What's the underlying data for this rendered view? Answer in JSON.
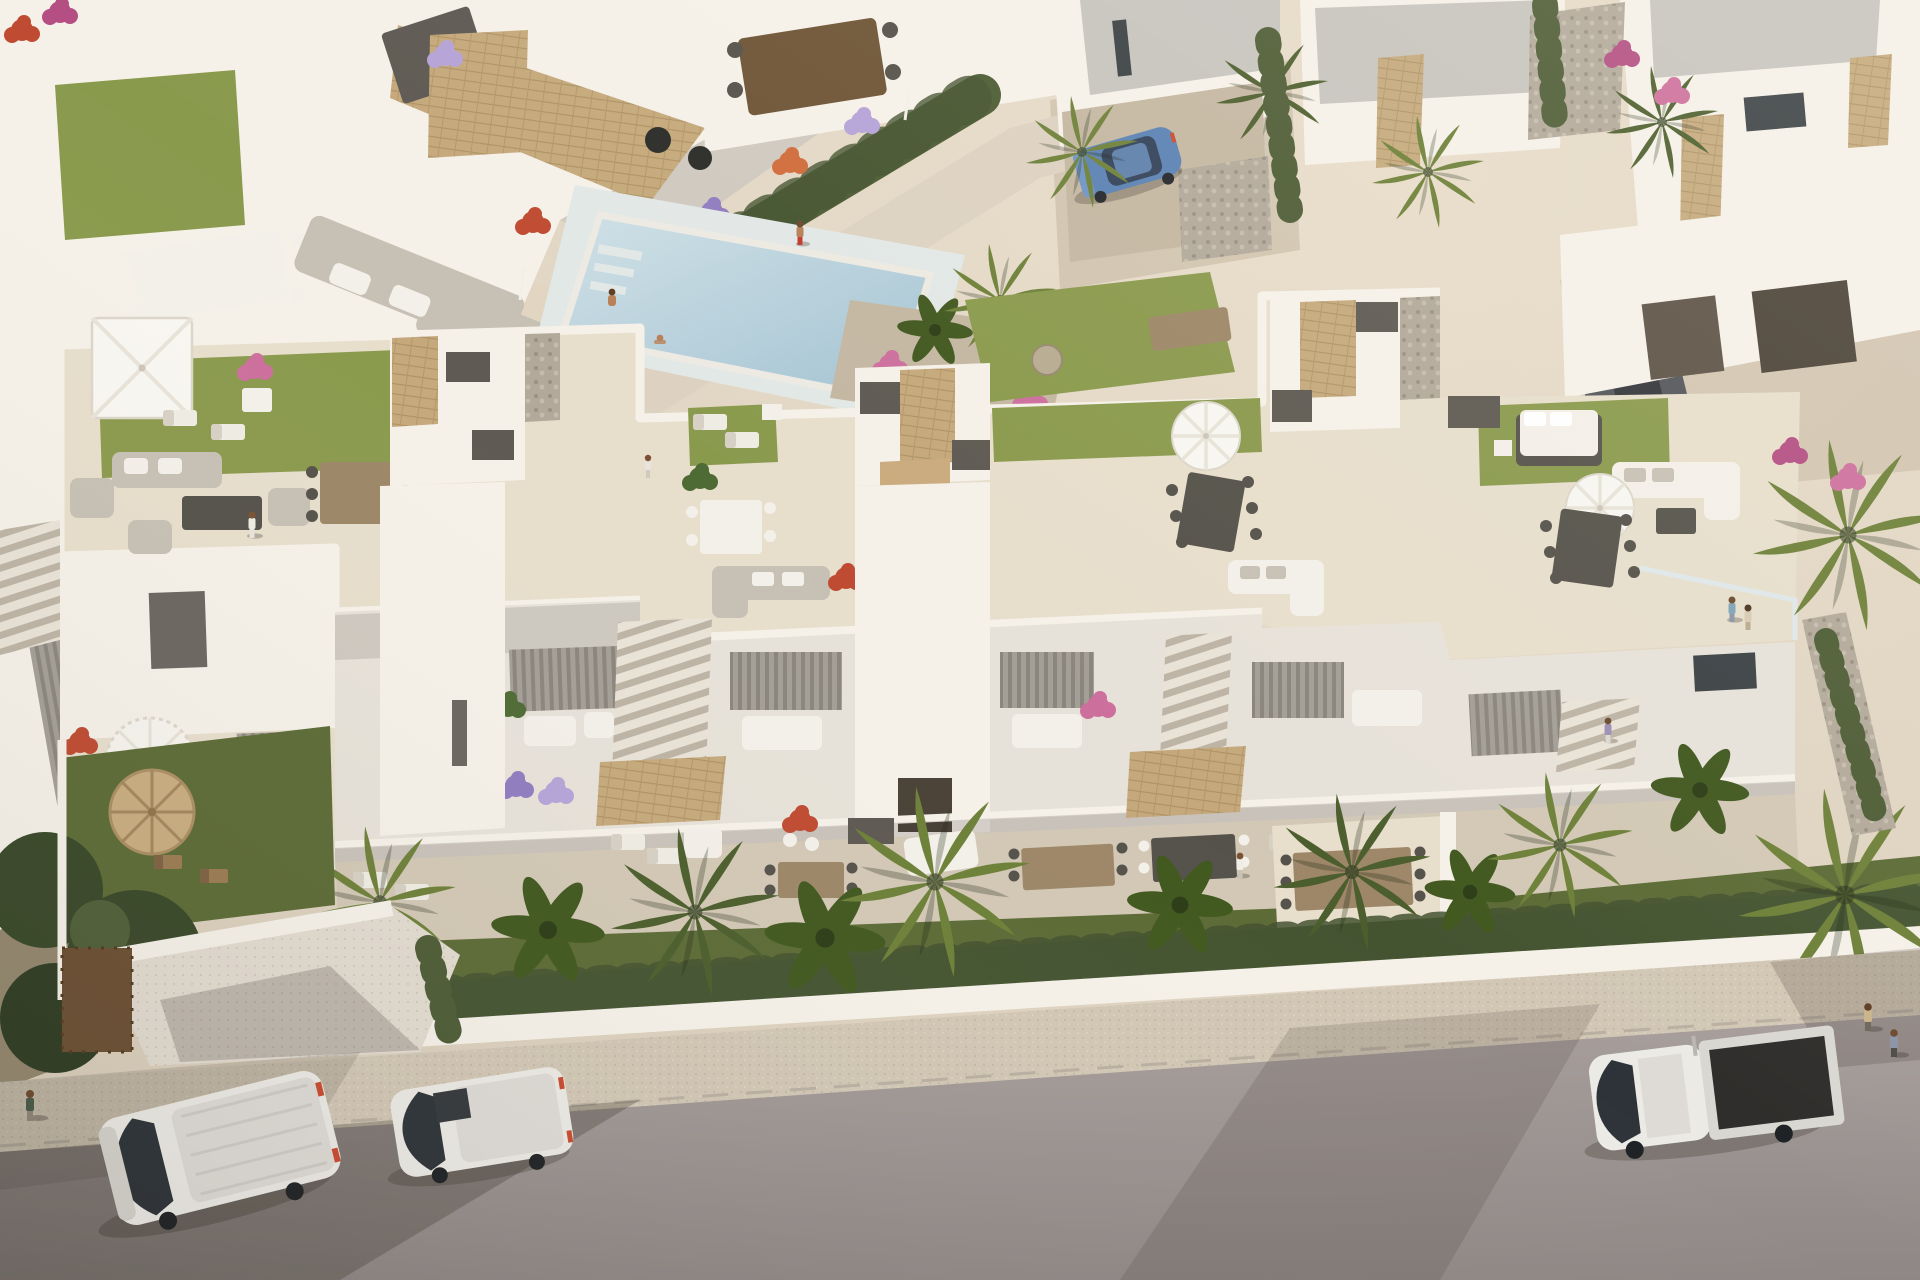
{
  "meta": {
    "type": "3d-architectural-aerial-render",
    "description": "Golden-hour aerial 3D rendering of a modern white Mediterranean residential development: a four-unit terraced apartment block with furnished rooftop terraces (artificial lawns, parasols, lounge and dining sets), recessed balconies and private front gardens behind a hedge-topped white wall; a communal pool with a planted promenade behind the block; surrounding white villas with stone-clad accents; an asphalt street in front with parked white vans and a flatbed pickup.",
    "time_of_day": "late afternoon, warm sunlight from upper right, long soft shadows toward lower left"
  },
  "palette": {
    "sand": "#d7cbb8",
    "sandLit": "#e8ddca",
    "gravel": "#c4b7a2",
    "dirt": "#93876e",
    "path": "#ddd2c2",
    "deck": "#e4dbc9",
    "travertine": "#e7decc",
    "travShade": "#d2c8b5",
    "wallLit": "#f5f1e9",
    "wallMid": "#e7e2d9",
    "wallShade": "#cfc9c0",
    "wallDim": "#b7b1a9",
    "roofGray": "#c7c4bf",
    "boxDark": "#5e5a53",
    "glass": "#3a4044",
    "curtain": "#908b84",
    "lawn": "#77873f",
    "lawnBright": "#8a9a4d",
    "lawnDark": "#5c6b36",
    "hedge": "#4d5c35",
    "cypress": "#435230",
    "treeDark": "#394829",
    "palmLight": "#6d8038",
    "palmDark": "#4c5e2d",
    "banana": "#41581f",
    "stoneTan": "#c3a87c",
    "pebble": "#b2a99a",
    "woodLight": "#c9ab7e",
    "woodMid": "#9d8768",
    "woodDark": "#6e5436",
    "furnWhite": "#f3f0e9",
    "furnGray": "#c7c0b4",
    "furnDark": "#55524b",
    "umbWhite": "#f8f6f1",
    "straw": "#c8ad7f",
    "poolLight": "#cfe0e6",
    "poolDeep": "#a2c2d2",
    "poolStep": "#e2e8e6",
    "road": "#a89f9d",
    "roadDark": "#8e8785",
    "sidewalk": "#d2c7b5",
    "curb": "#b9b0a2",
    "vehWhite": "#eceae5",
    "vehShade": "#cbc8c3",
    "vehGlass": "#2d3338",
    "carBlue": "#5b82b4",
    "carDark": "#53555a",
    "skin": "#b97f57",
    "shadow": "#3c342c",
    "flowerPurple": "#8f7cc0",
    "flowerLav": "#b5a3d8",
    "flowerPink": "#cd6f9d",
    "flowerMagenta": "#b44e83",
    "flowerRed": "#bf4b32",
    "flowerOrange": "#d06c3c",
    "flowerWhite": "#eef0f1"
  },
  "scene": {
    "main_building": {
      "label": "white terraced apartment block with staggered roofline",
      "units": 4,
      "rooftop_features": [
        "artificial lawn patches",
        "white square parasol",
        "two round white parasols",
        "gray lounge set with barbecue console",
        "wood dining set with six chairs",
        "white dining set",
        "gray corner sofa",
        "white corner sofas",
        "sun loungers",
        "double daybed on lawn",
        "stone-clad stair bulkheads with dark planter boxes",
        "pebble strips",
        "glass balustrade with standing couple"
      ],
      "facade_features": [
        "recessed balconies with gray curtain glazing",
        "white parapets",
        "purple petunia flower boxes",
        "cantilevered sandstone canopies",
        "external white staircases",
        "dark timber entrance doors"
      ]
    },
    "amenities": {
      "pool": {
        "label": "communal swimming pool",
        "water": "pale blue",
        "details": [
          "white coping",
          "corner entry steps",
          "pale sun deck"
        ]
      },
      "promenade": {
        "label": "paved promenade",
        "planting": "clipped cypress hedge bordered by purple, white and orange flower beds"
      },
      "landscape_objects": [
        "palm island with pink, red and white flowers",
        "lawn with round stone sphere sculpture",
        "timber slat bench",
        "tall fan palms",
        "banana plants"
      ]
    },
    "neighborhood": {
      "top_left": "rear roof terraces of an identical townhouse row: lawn patch, white dining set, gray corner sofa, red planter, stone-clad stair wall, striped curtain glazing, purple balcony flowers",
      "top_center": "patio with pergola dining set, black planter pots, sandstone feature walls",
      "top_right": "detached white villas with flat gray roofs, sandstone-clad pillars, gravel drives, rock beds, pink bougainvillea and palms",
      "right": "neighbor villa garage court with dark parked car"
    },
    "gardens": {
      "front": [
        "ground-floor terraces with loungers, day beds and long timber dining tables",
        "dark green lawns",
        "row of fan palms and banana plants",
        "clipped hedge on white boundary wall",
        "straw parasol with two wooden deck chairs in left garden",
        "dark garden trees at lower left",
        "right garden patio with eight-seat timber table"
      ],
      "left": "walled drive-in court with white parapet walls and dark timber garage gate"
    },
    "street": {
      "surface": "asphalt road, concrete sidewalk with expansion joints",
      "vehicles": [
        {
          "type": "panel van",
          "color": "white",
          "position": "parked at left, angled toward curb"
        },
        {
          "type": "compact van",
          "color": "white",
          "position": "parked left of center"
        },
        {
          "type": "flatbed pickup truck",
          "color": "white with dark bed",
          "position": "parked at right"
        },
        {
          "type": "hatchback",
          "color": "steel blue",
          "position": "villa driveway, upper right"
        },
        {
          "type": "car",
          "color": "dark gray",
          "position": "garage court behind right end of block"
        }
      ]
    },
    "people": [
      {
        "activity": "walking",
        "location": "left rooftop terrace"
      },
      {
        "activity": "standing by planters",
        "location": "central roof terrace edge"
      },
      {
        "activity": "couple at glass railing",
        "location": "right rooftop terrace"
      },
      {
        "activity": "standing",
        "location": "right lower terrace"
      },
      {
        "activity": "walking",
        "location": "pool promenade"
      },
      {
        "activity": "sitting on pool edge",
        "location": "pool corner steps"
      },
      {
        "activity": "bathing",
        "location": "pool shallow end"
      },
      {
        "activity": "standing",
        "location": "right garden patio"
      },
      {
        "activity": "walking",
        "location": "sidewalk, far left"
      },
      {
        "activity": "couple walking",
        "location": "sidewalk, far right"
      }
    ]
  }
}
